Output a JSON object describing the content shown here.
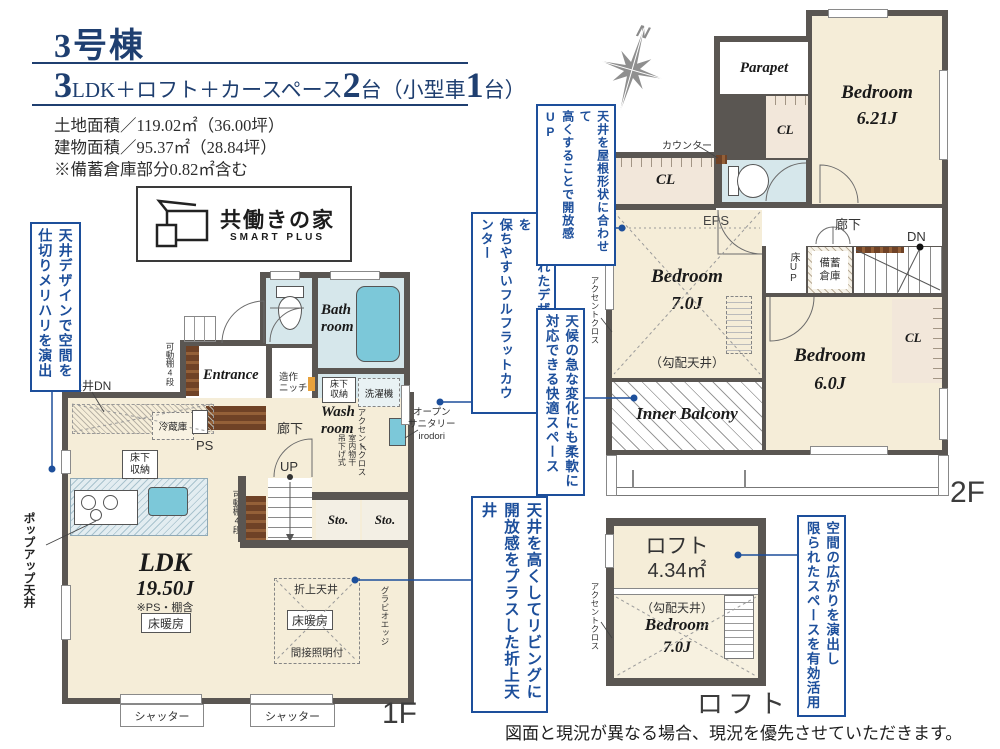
{
  "header": {
    "building": "3号棟",
    "layout": {
      "n1": "3",
      "t1": "LDK＋ロフト＋カースペース",
      "n2": "2",
      "t2": "台（小型車",
      "n3": "1",
      "t3": "台）"
    },
    "land_area": "土地面積／119.02㎡（36.00坪）",
    "building_area": "建物面積／95.37㎡（28.84坪）",
    "note": "※備蓄倉庫部分0.82㎡含む"
  },
  "logo": {
    "name": "共働きの家",
    "sub": "SMART PLUS"
  },
  "compass": {
    "n": "N"
  },
  "callouts": {
    "ceiling_design": {
      "line1": "天井デザインで空間を",
      "line2": "仕切りメリハリを演出"
    },
    "popup_ceiling": "ポップアップ天井",
    "flat_counter": {
      "line1": "洗練されたデザイン＋清潔感を",
      "line2": "保ちやすいフルフラットカウンター"
    },
    "oriage_ceiling": {
      "line1": "天井を高くしてリビングに",
      "line2": "開放感をプラスした折上天井"
    },
    "roof_shape": {
      "line1": "天井を屋根形状に合わせて",
      "line2": "高くすることで開放感UP"
    },
    "weather": {
      "line1": "天候の急な変化にも柔軟に",
      "line2": "対応できる快適スペース"
    },
    "loft_space": {
      "line1": "空間の広がりを演出し",
      "line2": "限られたスペースを有効活用"
    }
  },
  "common": {
    "cl": "CL",
    "sto": "Sto.",
    "rouka": "廊下",
    "accent": "アクセントクロス",
    "kobai": "（勾配天井）",
    "yukadanbo": "床暖房",
    "shutter": "シャッター",
    "kadoudana": "可動棚4段",
    "yukashita": "床下収納",
    "bedroom": "Bedroom"
  },
  "f1": {
    "floor_label": "1F",
    "entrance": "Entrance",
    "bath1": "Bath",
    "bath2": "room",
    "wash1": "Wash",
    "wash2": "room",
    "ldk": "LDK",
    "ldk_size": "19.50J",
    "ldk_note": "※PS・棚含",
    "tenjo_dn": "天井DN",
    "reizouko": "冷蔵庫",
    "ps": "PS",
    "up": "UP",
    "zousaku1": "造作",
    "zousaku2": "ニッチ",
    "sentakuki": "洗濯機",
    "monohoshi1": "室内物干",
    "monohoshi2": "吊下げ式",
    "opensani1": "オープン",
    "opensani2": "サニタリー",
    "opensani3": "irodori",
    "oriage": "折上天井",
    "kansetsu": "間接照明付",
    "gravio": "グラビオエッジ"
  },
  "f2": {
    "floor_label": "2F",
    "parapet": "Parapet",
    "b621": "6.21J",
    "b70": "7.0J",
    "b60": "6.0J",
    "counter": "カウンター",
    "eps": "EPS",
    "dn": "DN",
    "yuka_up": "床UP",
    "bichiku1": "備蓄",
    "bichiku2": "倉庫",
    "inner": "Inner Balcony"
  },
  "loft": {
    "caption": "ロフト",
    "name": "ロフト",
    "size": "4.34㎡",
    "b70": "7.0J"
  },
  "disclaimer": "図面と現況が異なる場合、現況を優先させていただきます。"
}
